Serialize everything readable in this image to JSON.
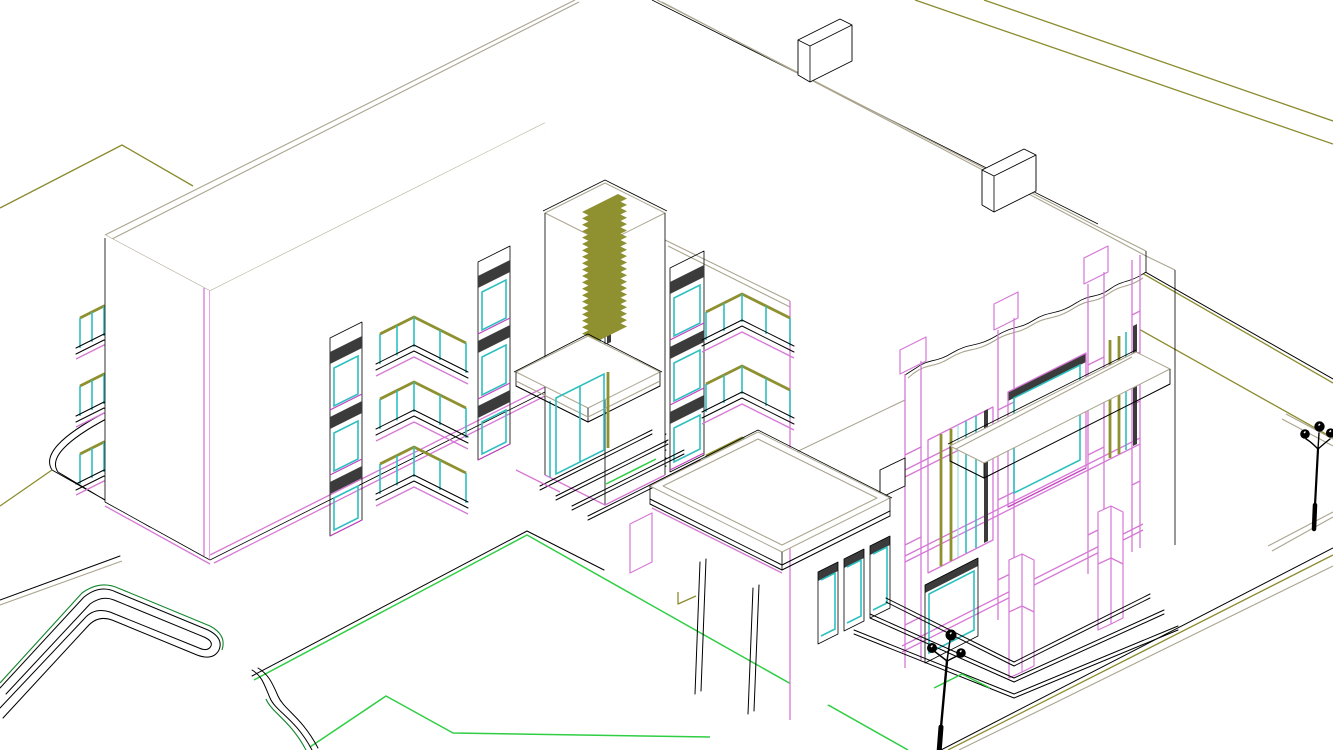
{
  "document": {
    "kind": "architectural-cad-wireframe-drawing",
    "projection": "isometric-axonometric",
    "background": "#ffffff",
    "description": "Line drawing of a three-storey residential building with a louvered stair tower, balcony stacks, entrance canopy with steps, flat-roof porch on slim columns, a magenta-framed right wing with wavy parapet, site roads, lawn plot and two street lamps"
  },
  "palette": {
    "line_black": "#000000",
    "roof_tan": "#aba58f",
    "site_olive": "#8b8b2e",
    "rail_olive": "#8f9030",
    "accent_magenta": "#d678d6",
    "accent_magenta_deep": "#c23fc2",
    "glass_cyan": "#2fbfbf",
    "glass_cyan_light": "#8fdede",
    "lawn_green": "#2fce43",
    "lawn_green_dark": "#12862c",
    "window_header_dark": "#3b3b3b",
    "shadow_gray": "#9a9a9a"
  },
  "scene": {
    "left_wing": {
      "floors": 3,
      "window_columns": 2,
      "windows_per_column": 3,
      "balcony_stack_balconies": 3,
      "end_balconies": 3
    },
    "stair_tower": {
      "louver_slats": 21,
      "entrance": {
        "canopy": true,
        "glass_door_panels": 2,
        "steps": 4
      }
    },
    "link_block": {
      "window_columns": 1,
      "windows": 3,
      "balconies": 3
    },
    "porch": {
      "flat_roof": true,
      "slim_columns": 2,
      "rear_windows": 3
    },
    "right_wing": {
      "pilasters": 4,
      "pilaster_joint_rows": 3,
      "horizontal_bands": 3,
      "picture_window": true,
      "mullion_window_bays": 2,
      "lower_window": true,
      "porch_columns": 2,
      "step_rings": 3,
      "wavy_parapet": true,
      "roof_parapet_notches": 2
    },
    "site": {
      "road_lines": [
        "top-left",
        "top-right",
        "right",
        "bottom-right"
      ],
      "lawn_plot": true,
      "curb_hook": true,
      "s_curve_curb": true,
      "street_lamps": [
        {
          "heads": 3
        },
        {
          "heads": 3
        }
      ]
    }
  }
}
